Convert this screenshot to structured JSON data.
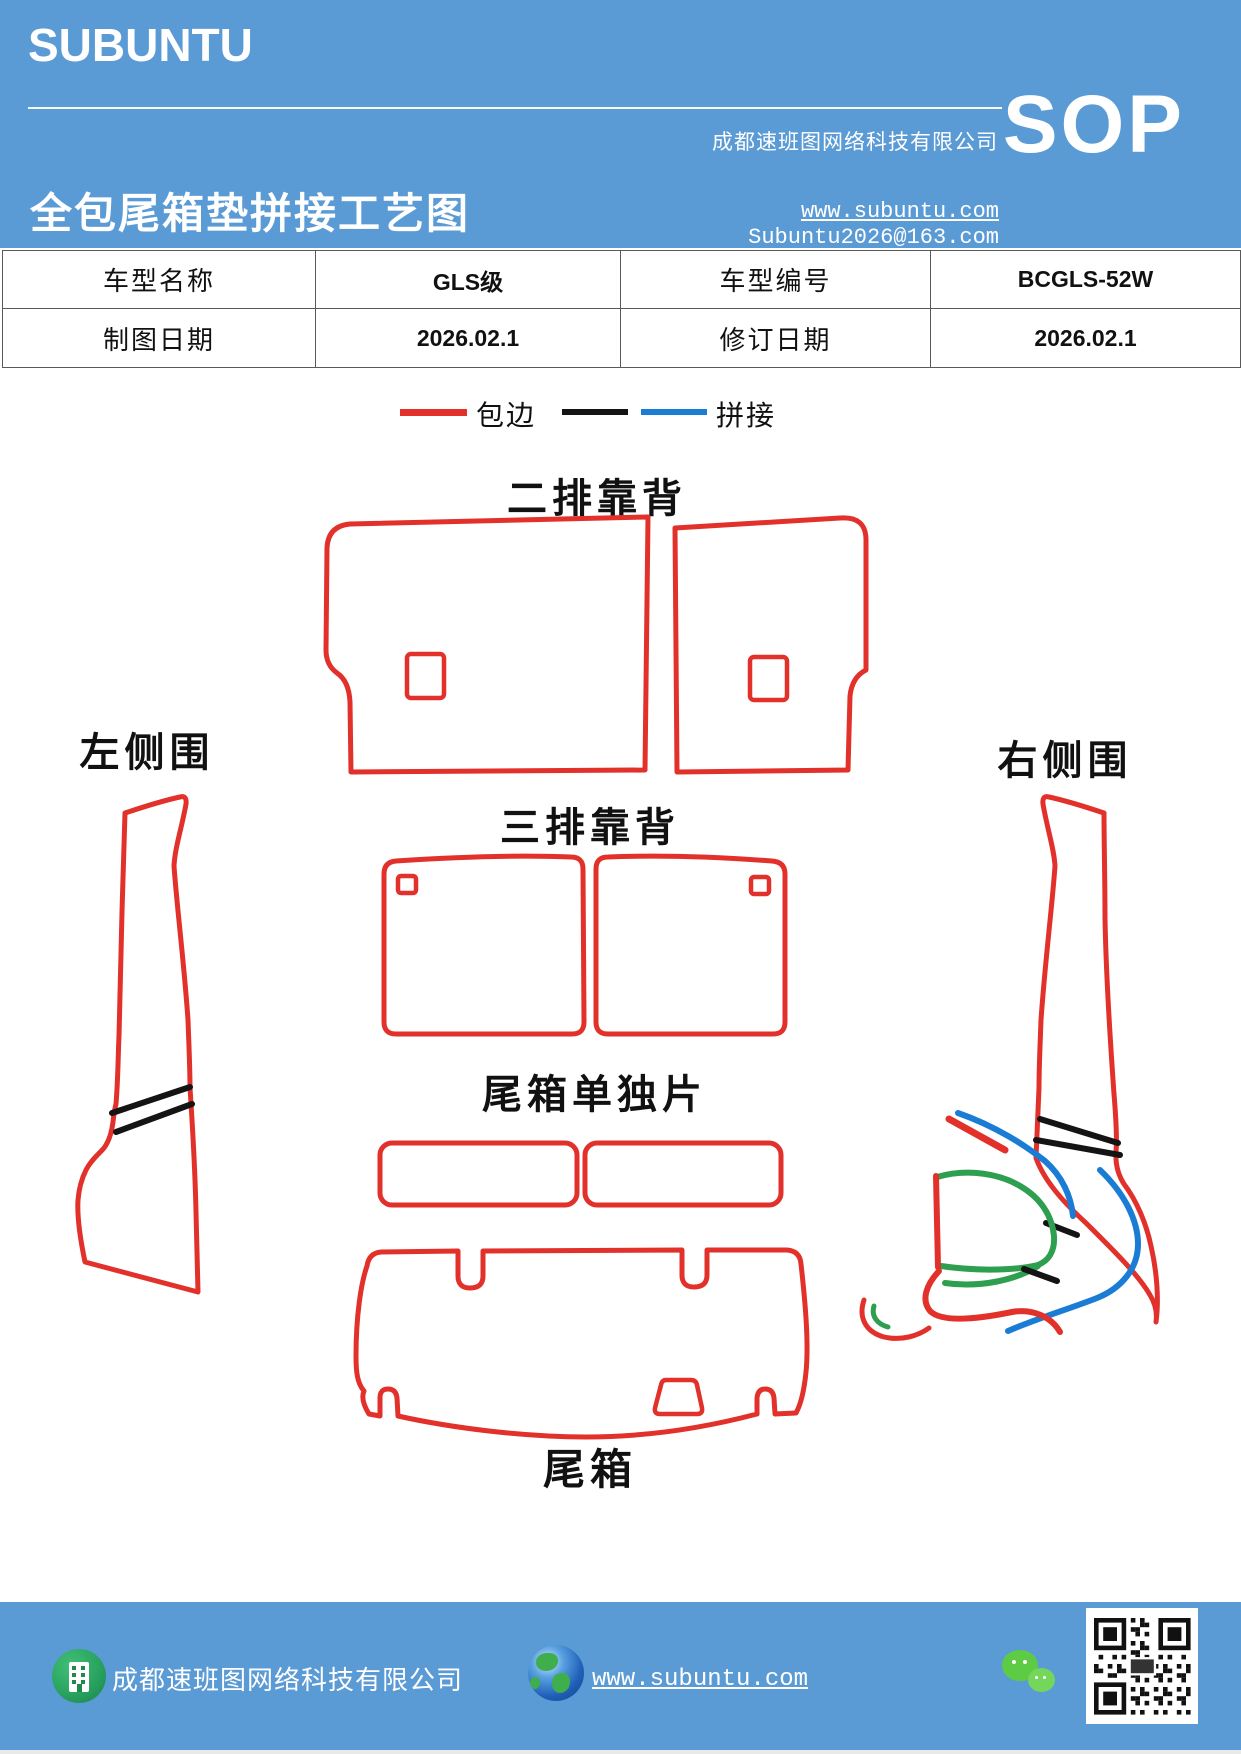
{
  "header": {
    "logo": "SUBUNTU",
    "doc_title": "全包尾箱垫拼接工艺图",
    "company": "成都速班图网络科技有限公司",
    "website": "www.subuntu.com",
    "email": "Subuntu2026@163.com",
    "badge": "SOP",
    "band_color": "#5B9BD5"
  },
  "info_table": {
    "rows": [
      {
        "cells": [
          "车型名称",
          "GLS级",
          "车型编号",
          "BCGLS-52W"
        ]
      },
      {
        "cells": [
          "制图日期",
          "2026.02.1",
          "修订日期",
          "2026.02.1"
        ]
      }
    ]
  },
  "legend": {
    "edge_label": "包边",
    "splice_label": "拼接",
    "edge_color": "#E2312B",
    "splice_black": "#141414",
    "splice_blue": "#1B7CD6"
  },
  "diagram": {
    "second_row_label": "二排靠背",
    "third_row_label": "三排靠背",
    "left_side_label": "左侧围",
    "right_side_label": "右侧围",
    "trunk_single_label": "尾箱单独片",
    "trunk_label": "尾箱",
    "outline_color": "#E2312B",
    "splice_black": "#141414",
    "splice_blue": "#1B7CD6",
    "splice_green": "#2E9E4F"
  },
  "footer": {
    "company": "成都速班图网络科技有限公司",
    "website": "www.subuntu.com"
  }
}
